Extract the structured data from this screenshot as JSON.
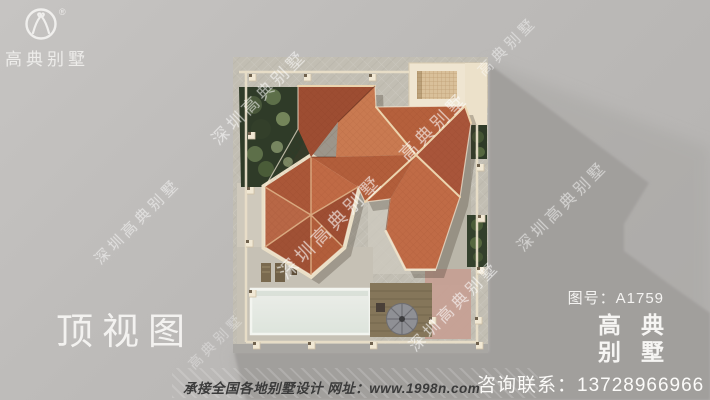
{
  "logo": {
    "brand": "高典别墅",
    "registered": "®"
  },
  "title": "顶视图",
  "drawing": {
    "number": "图号：A1759"
  },
  "brand_block": {
    "line1": "高 典",
    "line2": "别 墅"
  },
  "footer": {
    "services": "承接全国各地别墅设计 网址：www.1998n.com",
    "contact": "咨询联系：13728966966"
  },
  "watermarks": [
    {
      "text": "深圳高典别墅",
      "x": 137,
      "y": 221,
      "size": 15,
      "opacity": 0.5
    },
    {
      "text": "深圳高典别墅",
      "x": 258,
      "y": 96,
      "size": 17,
      "opacity": 0.55
    },
    {
      "text": "高典别墅",
      "x": 433,
      "y": 126,
      "size": 18,
      "opacity": 0.6
    },
    {
      "text": "深圳高典别墅",
      "x": 330,
      "y": 226,
      "size": 19,
      "opacity": 0.6
    },
    {
      "text": "深圳高典别墅",
      "x": 453,
      "y": 305,
      "size": 16,
      "opacity": 0.6
    },
    {
      "text": "深圳高典别墅",
      "x": 561,
      "y": 205,
      "size": 16,
      "opacity": 0.5
    },
    {
      "text": "高典别墅",
      "x": 507,
      "y": 46,
      "size": 15,
      "opacity": 0.45
    },
    {
      "text": "高典别墅",
      "x": 216,
      "y": 341,
      "size": 14,
      "opacity": 0.32
    }
  ],
  "colors": {
    "background_gray": "#bcbab8",
    "shadow_gray": "#a19f9c",
    "roof_terracotta": "#b2603c",
    "roof_ridge_cream": "#ecd4ae",
    "fence_cream": "#f1e8d4",
    "garden_green": "#2f3b28",
    "pool_white": "#e7ebe5",
    "deck_brown": "#85765a",
    "text_white": "#f3f2f0",
    "footer_text_dark": "#3b3b3b"
  }
}
